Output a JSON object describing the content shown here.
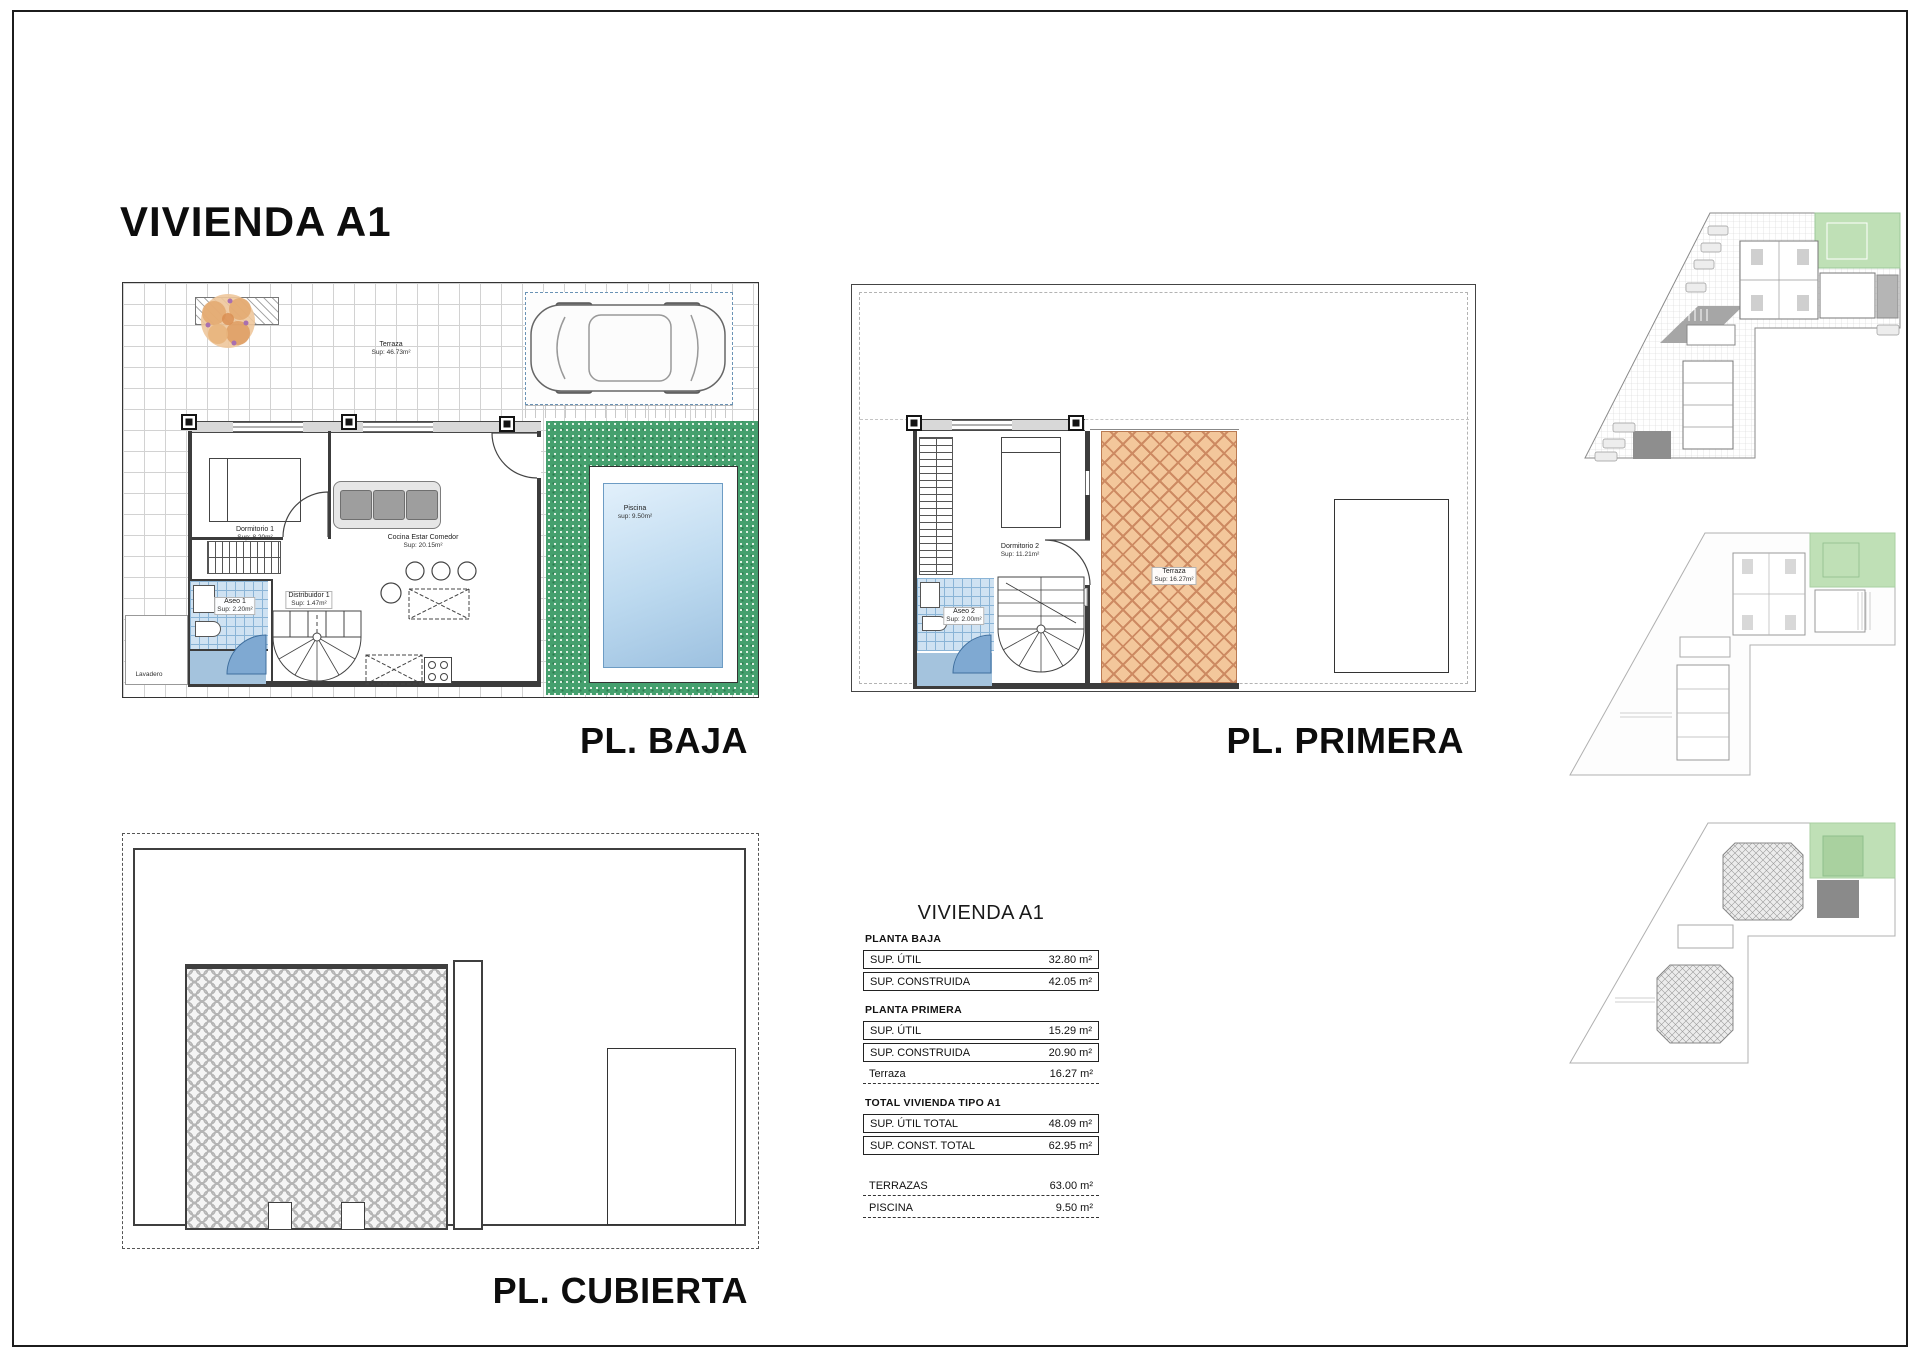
{
  "page": {
    "title": "VIVIENDA A1"
  },
  "colors": {
    "grass_green": "#45a06e",
    "terrace_orange": "#f3c79b",
    "pool_blue": "#bcd9ef",
    "tile_blue": "#cfe2f2",
    "highlight_green": "#bfe0b6",
    "wall_dark": "#3c3c3c"
  },
  "plans": {
    "baja": {
      "caption": "PL. BAJA",
      "labels": {
        "terraza": "Terraza",
        "terraza_sup": "Sup: 46.73m²",
        "dormitorio1": "Dormitorio 1",
        "dormitorio1_sup": "Sup: 8.20m²",
        "cocina": "Cocina Estar Comedor",
        "cocina_sup": "Sup: 20.15m²",
        "aseo1": "Aseo 1",
        "aseo1_sup": "Sup: 2.20m²",
        "distribuidor1": "Distribuidor 1",
        "distribuidor1_sup": "Sup: 1.47m²",
        "lavadero": "Lavadero",
        "piscina": "Piscina",
        "piscina_sup": "sup: 9.50m²"
      }
    },
    "primera": {
      "caption": "PL. PRIMERA",
      "labels": {
        "dormitorio2": "Dormitorio 2",
        "dormitorio2_sup": "Sup: 11.21m²",
        "aseo2": "Aseo 2",
        "aseo2_sup": "Sup: 2.00m²",
        "distribuidor2": "Distribuidor 2",
        "distribuidor2_sup": "Sup: 2.08m²",
        "terraza": "Terraza",
        "terraza_sup": "Sup: 16.27m²"
      }
    },
    "cubierta": {
      "caption": "PL. CUBIERTA"
    }
  },
  "summary_table": {
    "title": "VIVIENDA A1",
    "sections": [
      {
        "heading": "PLANTA BAJA",
        "rows": [
          {
            "label": "SUP. ÚTIL",
            "value": "32.80 m²",
            "style": "boxed"
          },
          {
            "label": "SUP. CONSTRUIDA",
            "value": "42.05 m²",
            "style": "boxed"
          }
        ]
      },
      {
        "heading": "PLANTA PRIMERA",
        "rows": [
          {
            "label": "SUP. ÚTIL",
            "value": "15.29 m²",
            "style": "boxed"
          },
          {
            "label": "SUP. CONSTRUIDA",
            "value": "20.90 m²",
            "style": "boxed"
          },
          {
            "label": "Terraza",
            "value": "16.27 m²",
            "style": "dashed"
          }
        ]
      },
      {
        "heading": "TOTAL VIVIENDA TIPO A1",
        "rows": [
          {
            "label": "SUP. ÚTIL TOTAL",
            "value": "48.09 m²",
            "style": "boxed"
          },
          {
            "label": "SUP. CONST. TOTAL",
            "value": "62.95 m²",
            "style": "boxed"
          }
        ]
      },
      {
        "heading": "",
        "rows": [
          {
            "label": "TERRAZAS",
            "value": "63.00 m²",
            "style": "dashed"
          },
          {
            "label": "PISCINA",
            "value": "9.50 m²",
            "style": "dashed"
          }
        ]
      }
    ]
  }
}
